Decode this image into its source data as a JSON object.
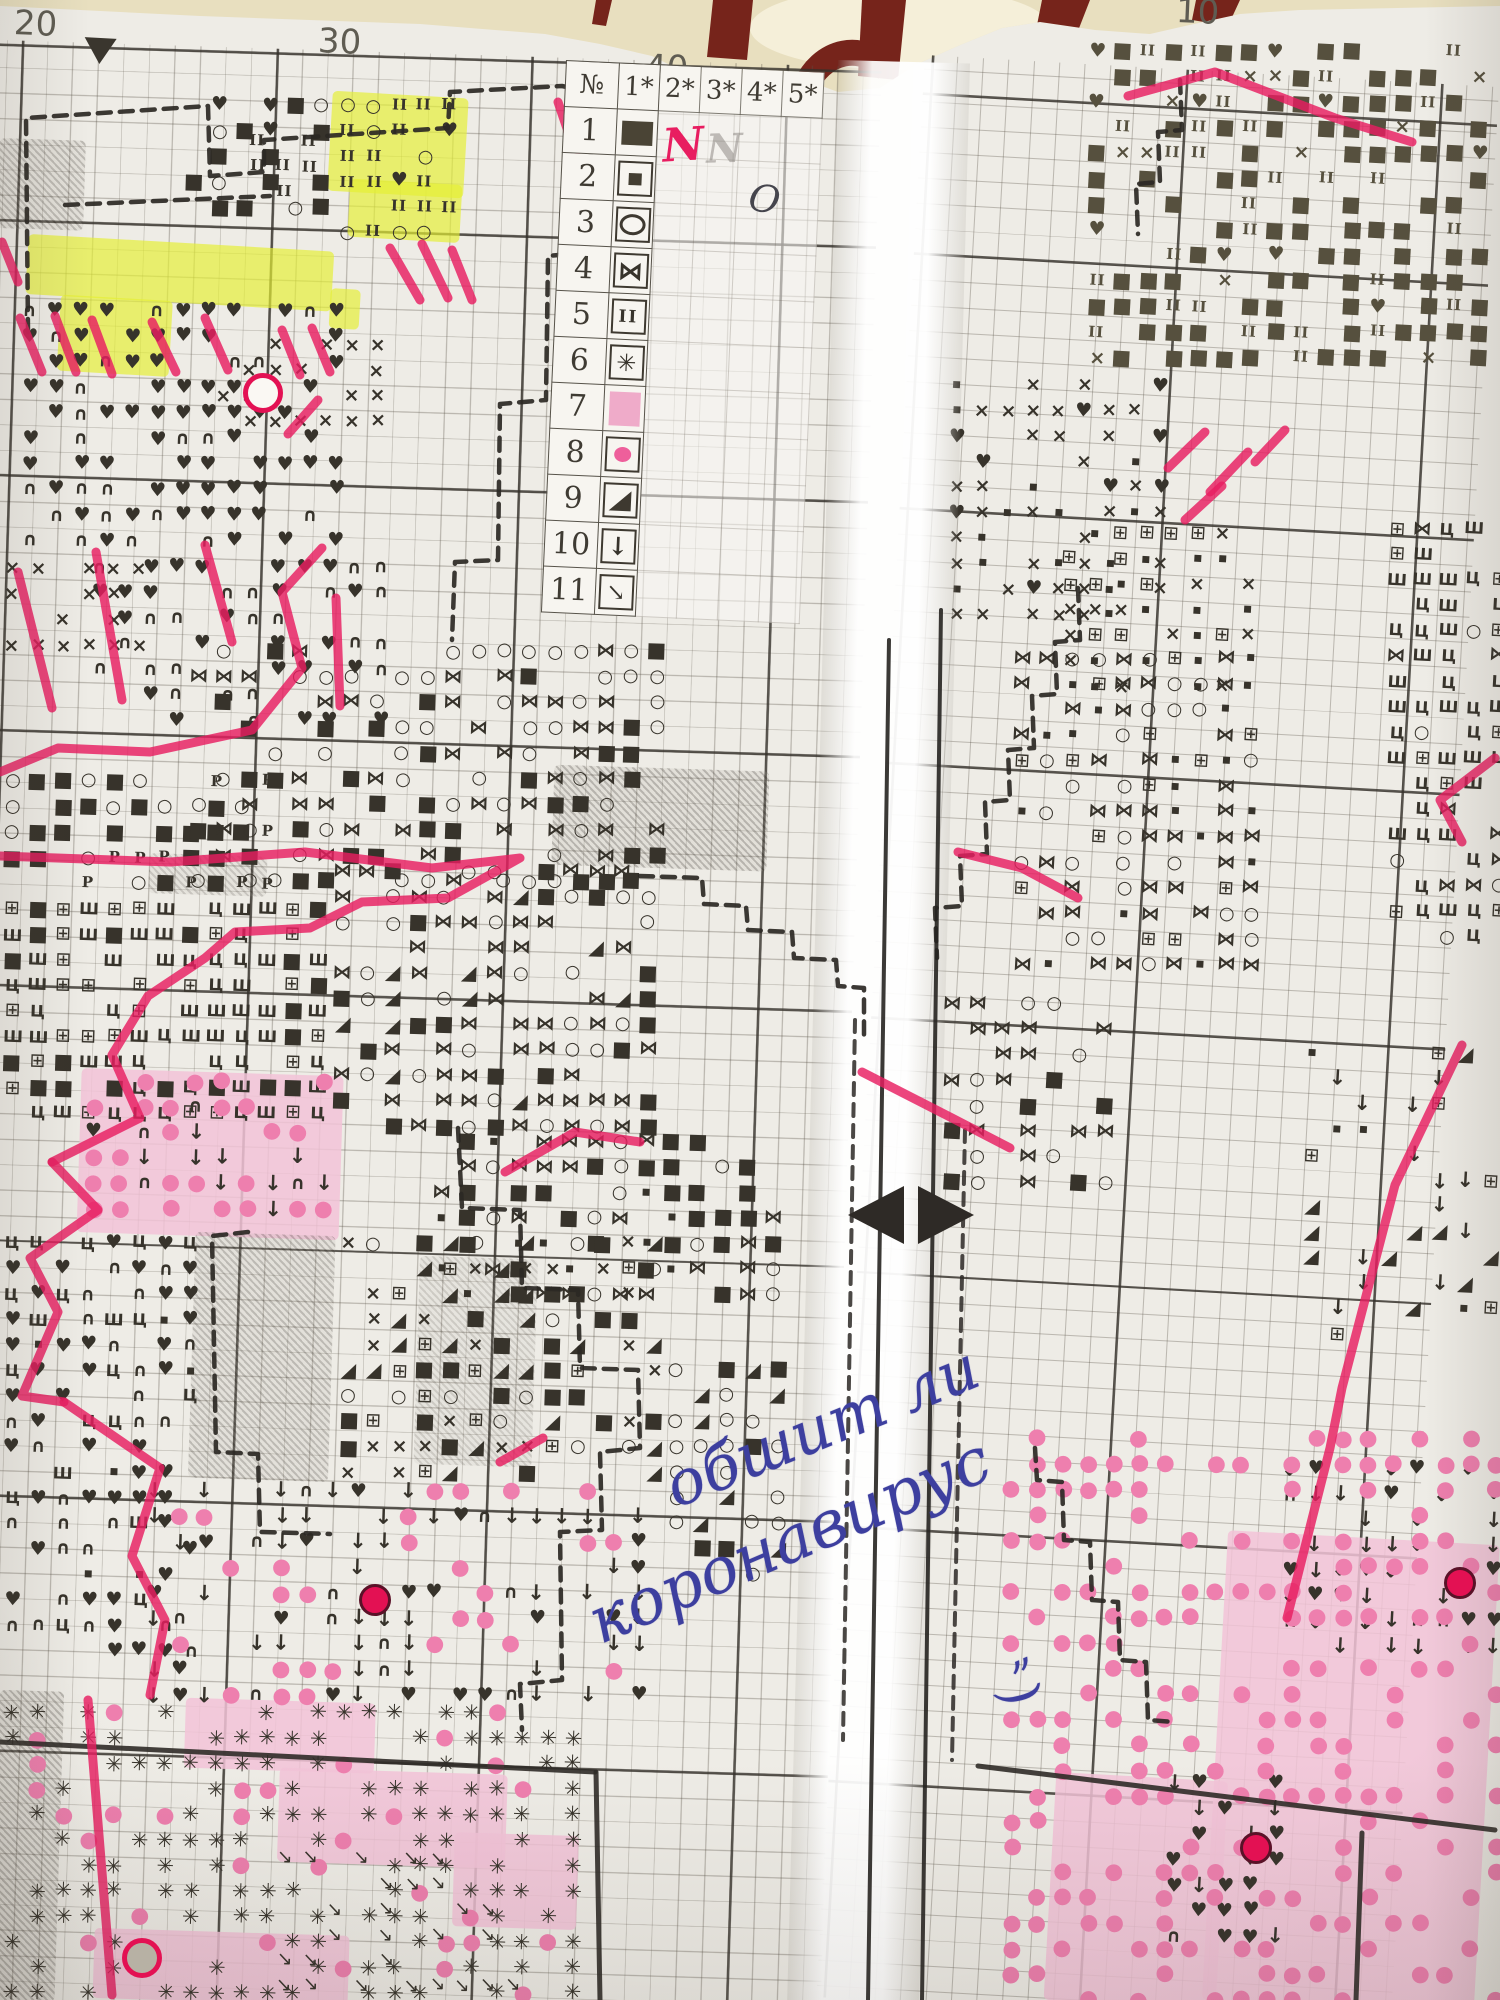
{
  "colors": {
    "paper": "#eeece6",
    "cream": "#e8dfbf",
    "cream_light": "#f5efd9",
    "maroon": "#76241b",
    "grid_minor": "rgba(88,82,70,0.34)",
    "grid_major": "rgba(52,48,42,0.80)",
    "ink": "#37332b",
    "checker": "#56503e",
    "pink_marker": "#e81d60",
    "yellow": "#e4ef33",
    "pink_cell": "#f2c3d7",
    "pink_dot": "#ee7fae",
    "bead": "#e31153",
    "blue_ink": "#3d3f9f"
  },
  "ruler": {
    "labels": [
      {
        "t": "20",
        "x": 14,
        "y": 4
      },
      {
        "t": "30",
        "x": 318,
        "y": 22
      },
      {
        "t": "40",
        "x": 645,
        "y": 48
      },
      {
        "t": "10",
        "x": 1176,
        "y": -8
      }
    ],
    "marker": {
      "x": 84,
      "y": 38
    }
  },
  "legend": {
    "headers": [
      "№",
      "1*",
      "2*",
      "3*",
      "4*",
      "5*"
    ],
    "rows": [
      {
        "n": "1",
        "sym": "solid-rect"
      },
      {
        "n": "2",
        "sym": "small-square"
      },
      {
        "n": "3",
        "sym": "ellipse"
      },
      {
        "n": "4",
        "sym": "bowtie"
      },
      {
        "n": "5",
        "sym": "double-bar"
      },
      {
        "n": "6",
        "sym": "star"
      },
      {
        "n": "7",
        "sym": "pink-fill"
      },
      {
        "n": "8",
        "sym": "pink-dot"
      },
      {
        "n": "9",
        "sym": "triangle"
      },
      {
        "n": "10",
        "sym": "arrow-down"
      },
      {
        "n": "11",
        "sym": "arrow-diag"
      }
    ],
    "annotations": [
      {
        "t": "N",
        "x": 100,
        "y": 52,
        "cls": "ann-pink"
      },
      {
        "t": "N",
        "x": 144,
        "y": 58,
        "cls": "ann-pencil"
      },
      {
        "t": "O",
        "x": 189,
        "y": 108,
        "cls": "ann-pen"
      }
    ]
  },
  "handwriting": {
    "line1": "обшит ли",
    "line2": "коронавирус",
    "mark": "„",
    "mark2": ")"
  },
  "icons": {
    "heart": "♥",
    "arc": "∩",
    "cross": "×",
    "circle": "○",
    "square": "■",
    "sqsmall": "▪",
    "bowtie": "⋈",
    "tri": "◢",
    "down": "↓",
    "se": "↘",
    "star": "✳",
    "bars": "II",
    "sha": "Ш",
    "tse": "Ц",
    "boxed": "⊞",
    "pe": "P",
    "pdot": "●"
  },
  "regions": [
    {
      "p": "L",
      "x": 18,
      "y": 298,
      "w": 336,
      "h": 256,
      "g": [
        [
          "heart",
          10
        ],
        [
          "arc",
          3
        ],
        [
          "",
          7
        ]
      ]
    },
    {
      "p": "L",
      "x": 88,
      "y": 554,
      "w": 300,
      "h": 190,
      "g": [
        [
          "heart",
          7
        ],
        [
          "arc",
          4
        ],
        [
          "",
          9
        ]
      ]
    },
    {
      "p": "L",
      "x": 0,
      "y": 556,
      "w": 160,
      "h": 120,
      "g": [
        [
          "cross",
          7
        ],
        [
          "",
          3
        ]
      ]
    },
    {
      "p": "L",
      "x": 212,
      "y": 332,
      "w": 190,
      "h": 92,
      "g": [
        [
          "cross",
          5
        ],
        [
          "",
          5
        ]
      ]
    },
    {
      "p": "L",
      "x": 336,
      "y": 92,
      "w": 128,
      "h": 142,
      "g": [
        [
          "bars",
          6
        ],
        [
          "circle",
          3
        ],
        [
          "heart",
          1
        ],
        [
          "",
          2
        ]
      ]
    },
    {
      "p": "L",
      "x": 246,
      "y": 128,
      "w": 88,
      "h": 100,
      "g": [
        [
          "bars",
          5
        ],
        [
          "",
          5
        ]
      ]
    },
    {
      "p": "L",
      "x": 182,
      "y": 92,
      "w": 150,
      "h": 120,
      "g": [
        [
          "square",
          5
        ],
        [
          "heart",
          2
        ],
        [
          "circle",
          1
        ],
        [
          "",
          4
        ]
      ]
    },
    {
      "p": "L",
      "x": 0,
      "y": 768,
      "w": 272,
      "h": 128,
      "g": [
        [
          "pe",
          3
        ],
        [
          "square",
          4
        ],
        [
          "circle",
          3
        ],
        [
          "",
          4
        ]
      ]
    },
    {
      "p": "L",
      "x": 186,
      "y": 638,
      "w": 482,
      "h": 252,
      "g": [
        [
          "bowtie",
          5
        ],
        [
          "circle",
          5
        ],
        [
          "square",
          4
        ],
        [
          "",
          6
        ]
      ]
    },
    {
      "p": "L",
      "x": 430,
      "y": 1128,
      "w": 360,
      "h": 180,
      "g": [
        [
          "bowtie",
          6
        ],
        [
          "square",
          5
        ],
        [
          "sqsmall",
          3
        ],
        [
          "circle",
          3
        ],
        [
          "",
          4
        ]
      ]
    },
    {
      "p": "L",
      "x": 0,
      "y": 896,
      "w": 330,
      "h": 236,
      "g": [
        [
          "sha",
          5
        ],
        [
          "tse",
          4
        ],
        [
          "boxed",
          3
        ],
        [
          "square",
          2
        ],
        [
          "",
          4
        ]
      ]
    },
    {
      "p": "L",
      "x": 330,
      "y": 858,
      "w": 340,
      "h": 272,
      "g": [
        [
          "bowtie",
          6
        ],
        [
          "square",
          4
        ],
        [
          "circle",
          4
        ],
        [
          "tri",
          1
        ],
        [
          "",
          5
        ]
      ]
    },
    {
      "p": "L",
      "x": 82,
      "y": 1068,
      "w": 262,
      "h": 164,
      "g": [
        [
          "pdot",
          6
        ],
        [
          "down",
          2
        ],
        [
          "arc",
          1
        ],
        [
          "heart",
          1
        ],
        [
          "",
          6
        ]
      ]
    },
    {
      "p": "L",
      "x": 0,
      "y": 1230,
      "w": 200,
      "h": 430,
      "g": [
        [
          "arc",
          5
        ],
        [
          "heart",
          4
        ],
        [
          "tse",
          2
        ],
        [
          "sha",
          1
        ],
        [
          "sqsmall",
          1
        ],
        [
          "",
          8
        ]
      ]
    },
    {
      "p": "L",
      "x": 336,
      "y": 1230,
      "w": 336,
      "h": 266,
      "g": [
        [
          "cross",
          4
        ],
        [
          "tri",
          4
        ],
        [
          "square",
          3
        ],
        [
          "boxed",
          2
        ],
        [
          "circle",
          2
        ],
        [
          "",
          6
        ]
      ]
    },
    {
      "p": "L",
      "x": 664,
      "y": 1356,
      "w": 130,
      "h": 230,
      "g": [
        [
          "circle",
          5
        ],
        [
          "tri",
          2
        ],
        [
          "square",
          1
        ],
        [
          "",
          5
        ]
      ]
    },
    {
      "p": "L",
      "x": 142,
      "y": 1478,
      "w": 500,
      "h": 240,
      "g": [
        [
          "down",
          5
        ],
        [
          "arc",
          2
        ],
        [
          "heart",
          2
        ],
        [
          "pdot",
          3
        ],
        [
          "",
          9
        ]
      ]
    },
    {
      "p": "L",
      "x": 0,
      "y": 1700,
      "w": 580,
      "h": 300,
      "g": [
        [
          "star",
          8
        ],
        [
          "pdot",
          2
        ],
        [
          "",
          6
        ]
      ]
    },
    {
      "p": "L",
      "x": 272,
      "y": 1845,
      "w": 250,
      "h": 155,
      "g": [
        [
          "se",
          5
        ],
        [
          "",
          5
        ]
      ]
    },
    {
      "p": "R",
      "x": 1085,
      "y": 38,
      "w": 415,
      "h": 330,
      "c": "#56503e",
      "g": [
        [
          "square",
          8
        ],
        [
          "bars",
          3
        ],
        [
          "cross",
          1
        ],
        [
          "heart",
          1
        ],
        [
          "",
          7
        ]
      ]
    },
    {
      "p": "R",
      "x": 945,
      "y": 372,
      "w": 230,
      "h": 265,
      "g": [
        [
          "cross",
          5
        ],
        [
          "sqsmall",
          3
        ],
        [
          "heart",
          1
        ],
        [
          "",
          6
        ]
      ]
    },
    {
      "p": "R",
      "x": 1058,
      "y": 520,
      "w": 210,
      "h": 190,
      "g": [
        [
          "cross",
          4
        ],
        [
          "sqsmall",
          3
        ],
        [
          "boxed",
          2
        ],
        [
          "",
          6
        ]
      ]
    },
    {
      "p": "R",
      "x": 1010,
      "y": 645,
      "w": 250,
      "h": 340,
      "g": [
        [
          "bowtie",
          6
        ],
        [
          "circle",
          4
        ],
        [
          "sqsmall",
          3
        ],
        [
          "boxed",
          2
        ],
        [
          "",
          6
        ]
      ]
    },
    {
      "p": "R",
      "x": 1385,
      "y": 515,
      "w": 115,
      "h": 430,
      "g": [
        [
          "sha",
          4
        ],
        [
          "tse",
          3
        ],
        [
          "boxed",
          3
        ],
        [
          "circle",
          2
        ],
        [
          "bowtie",
          2
        ],
        [
          "",
          4
        ]
      ]
    },
    {
      "p": "R",
      "x": 940,
      "y": 990,
      "w": 180,
      "h": 200,
      "g": [
        [
          "bowtie",
          4
        ],
        [
          "circle",
          3
        ],
        [
          "square",
          2
        ],
        [
          "",
          8
        ]
      ]
    },
    {
      "p": "R",
      "x": 1300,
      "y": 1040,
      "w": 200,
      "h": 300,
      "g": [
        [
          "down",
          3
        ],
        [
          "tri",
          2
        ],
        [
          "boxed",
          2
        ],
        [
          "sqsmall",
          1
        ],
        [
          "",
          14
        ]
      ]
    },
    {
      "p": "R",
      "x": 1278,
      "y": 1455,
      "w": 222,
      "h": 210,
      "g": [
        [
          "down",
          6
        ],
        [
          "heart",
          2
        ],
        [
          "arc",
          1
        ],
        [
          "",
          6
        ]
      ]
    },
    {
      "p": "R",
      "x": 1162,
      "y": 1770,
      "w": 140,
      "h": 190,
      "g": [
        [
          "heart",
          7
        ],
        [
          "down",
          2
        ],
        [
          "arc",
          1
        ],
        [
          "",
          4
        ]
      ]
    },
    {
      "p": "R",
      "x": 1000,
      "y": 1425,
      "w": 500,
      "h": 575,
      "g": [
        [
          "pdot",
          6
        ],
        [
          "",
          9
        ]
      ]
    }
  ],
  "patches": {
    "yellow": [
      [
        332,
        92,
        136,
        100
      ],
      [
        350,
        180,
        112,
        58
      ],
      [
        28,
        238,
        306,
        60
      ],
      [
        60,
        296,
        112,
        76
      ],
      [
        330,
        288,
        30,
        40
      ]
    ],
    "gray": [
      [
        555,
        765,
        215,
        100,
        0.5
      ],
      [
        150,
        853,
        118,
        40,
        0.35
      ],
      [
        196,
        1232,
        140,
        246,
        0.45
      ],
      [
        0,
        1690,
        64,
        310,
        0.5
      ],
      [
        0,
        138,
        86,
        90,
        0.45
      ],
      [
        420,
        1256,
        118,
        208,
        0.3
      ]
    ],
    "pink": [
      [
        82,
        1068,
        262,
        164
      ],
      [
        186,
        1698,
        190,
        70
      ],
      [
        280,
        1768,
        228,
        94
      ],
      [
        95,
        1928,
        255,
        70
      ],
      [
        455,
        1832,
        124,
        94
      ],
      [
        1228,
        1530,
        272,
        470
      ],
      [
        1056,
        1772,
        172,
        228
      ]
    ]
  },
  "beads": [
    [
      372,
      1597
    ],
    [
      1457,
      1580
    ],
    [
      1253,
      1845
    ]
  ],
  "rings": [
    {
      "x": 258,
      "y": 388,
      "fill": "#faf8f3"
    },
    {
      "x": 137,
      "y": 1953,
      "fill": "#b7b1a4"
    }
  ],
  "highlighter": [
    [
      [
        558,
        102
      ],
      [
        577,
        158
      ]
    ],
    [
      [
        2,
        242
      ],
      [
        18,
        282
      ]
    ],
    [
      [
        1128,
        96
      ],
      [
        1215,
        72
      ],
      [
        1335,
        118
      ],
      [
        1412,
        142
      ]
    ],
    [
      [
        20,
        318
      ],
      [
        42,
        372
      ]
    ],
    [
      [
        55,
        316
      ],
      [
        76,
        372
      ]
    ],
    [
      [
        92,
        320
      ],
      [
        112,
        374
      ]
    ],
    [
      [
        152,
        322
      ],
      [
        176,
        372
      ]
    ],
    [
      [
        205,
        318
      ],
      [
        228,
        370
      ]
    ],
    [
      [
        282,
        330
      ],
      [
        300,
        375
      ]
    ],
    [
      [
        312,
        328
      ],
      [
        330,
        372
      ]
    ],
    [
      [
        390,
        248
      ],
      [
        420,
        300
      ]
    ],
    [
      [
        422,
        244
      ],
      [
        448,
        298
      ]
    ],
    [
      [
        452,
        250
      ],
      [
        472,
        300
      ]
    ],
    [
      [
        288,
        434
      ],
      [
        318,
        400
      ]
    ],
    [
      [
        1168,
        468
      ],
      [
        1205,
        432
      ]
    ],
    [
      [
        1210,
        492
      ],
      [
        1248,
        452
      ]
    ],
    [
      [
        1185,
        520
      ],
      [
        1222,
        486
      ]
    ],
    [
      [
        1255,
        462
      ],
      [
        1285,
        430
      ]
    ],
    [
      [
        18,
        572
      ],
      [
        52,
        708
      ]
    ],
    [
      [
        96,
        552
      ],
      [
        122,
        700
      ]
    ],
    [
      [
        205,
        545
      ],
      [
        232,
        642
      ]
    ],
    [
      [
        336,
        598
      ],
      [
        340,
        706
      ]
    ],
    [
      [
        322,
        548
      ],
      [
        282,
        592
      ],
      [
        302,
        668
      ],
      [
        252,
        730
      ],
      [
        150,
        752
      ],
      [
        58,
        748
      ],
      [
        0,
        772
      ]
    ],
    [
      [
        0,
        856
      ],
      [
        170,
        862
      ],
      [
        305,
        852
      ],
      [
        432,
        868
      ],
      [
        520,
        858
      ],
      [
        448,
        898
      ],
      [
        362,
        902
      ],
      [
        310,
        928
      ],
      [
        235,
        932
      ],
      [
        205,
        958
      ],
      [
        148,
        996
      ],
      [
        112,
        1055
      ],
      [
        140,
        1118
      ],
      [
        52,
        1162
      ]
    ],
    [
      [
        52,
        1162
      ],
      [
        98,
        1210
      ],
      [
        30,
        1258
      ],
      [
        58,
        1312
      ],
      [
        22,
        1396
      ],
      [
        64,
        1402
      ]
    ],
    [
      [
        64,
        1402
      ],
      [
        160,
        1468
      ],
      [
        132,
        1556
      ],
      [
        165,
        1620
      ],
      [
        150,
        1695
      ]
    ],
    [
      [
        88,
        1700
      ],
      [
        112,
        1995
      ]
    ],
    [
      [
        505,
        1172
      ],
      [
        575,
        1132
      ],
      [
        640,
        1142
      ]
    ],
    [
      [
        543,
        1438
      ],
      [
        500,
        1462
      ]
    ],
    [
      [
        958,
        852
      ],
      [
        1022,
        868
      ],
      [
        1078,
        898
      ]
    ],
    [
      [
        862,
        1072
      ],
      [
        952,
        1118
      ],
      [
        1010,
        1148
      ]
    ],
    [
      [
        1495,
        758
      ],
      [
        1440,
        800
      ],
      [
        1462,
        842
      ]
    ],
    [
      [
        1462,
        1045
      ],
      [
        1395,
        1185
      ],
      [
        1342,
        1388
      ],
      [
        1330,
        1448
      ],
      [
        1287,
        1618
      ]
    ]
  ],
  "dashed_outlines": [
    "M28,332 L26,118 L208,106 L210,176 L264,172 L264,140 L448,128 L450,92 L562,86 L590,92 L592,252 L548,256 L546,400 L500,404 L498,560 L455,562 L452,640",
    "M65,205 L270,196",
    "M640,876 L702,878 L704,904 L746,906 L748,930 L792,932 L794,958 L836,960 L838,986 L864,988 L864,1040",
    "M458,1128 L462,1208 L520,1210 L522,1288 L578,1290 L580,1368 L638,1370 L640,1448 L600,1452 L602,1530 L560,1532 L562,1680 L520,1684 L522,1730",
    "M248,1232 L212,1236 L216,1452 L258,1454 L260,1532 L330,1534",
    "M1078,588 L1080,640 L1055,642 L1057,694 L1032,696 L1034,748 L1008,750 L1010,800 L985,802 L987,854 L960,856 L962,906 L935,908 L937,958",
    "M1035,1448 L1037,1480 L1062,1482 L1064,1540 L1090,1542 L1092,1600 L1118,1602 L1120,1660 L1146,1662 L1148,1720 L1174,1722",
    "M1180,80 L1182,130 L1158,132 L1160,182 L1136,184 L1138,234"
  ],
  "solid_lines": [
    [
      [
        0,
        1742
      ],
      [
        595,
        1772
      ]
    ],
    [
      [
        596,
        1772
      ],
      [
        600,
        2000
      ]
    ],
    [
      [
        978,
        1766
      ],
      [
        1495,
        1830
      ]
    ],
    [
      [
        1362,
        1833
      ],
      [
        1356,
        2000
      ]
    ]
  ],
  "fold": {
    "rules": [
      [
        889,
        640,
        868,
        2000
      ],
      [
        941,
        610,
        922,
        2000
      ]
    ],
    "dashed_rules": [
      [
        855,
        1020,
        843,
        1740
      ],
      [
        965,
        1130,
        952,
        1760
      ]
    ]
  },
  "background": {
    "band_points": "0,0 1500,0 1500,6 1300,10 1240,14 1185,26 1150,34 1095,30 1040,22 1002,28 960,45 915,65 880,88 838,92 800,78 762,88 726,92 688,74 652,56 600,44 545,34 420,24 200,16 0,6",
    "straps": [
      "M596,0 L612,0 L606,26 L592,24 Z",
      "M713,0 L753,0 L747,60 L707,57 Z",
      "M862,0 L906,0 L898,80 L858,76 Z",
      "M1042,0 L1090,0 L1076,36 L1036,30 Z",
      "M1196,0 L1240,0 L1228,26 L1192,20 Z"
    ],
    "arch": "M806,86 A52,62 0 0 1 888,70"
  }
}
